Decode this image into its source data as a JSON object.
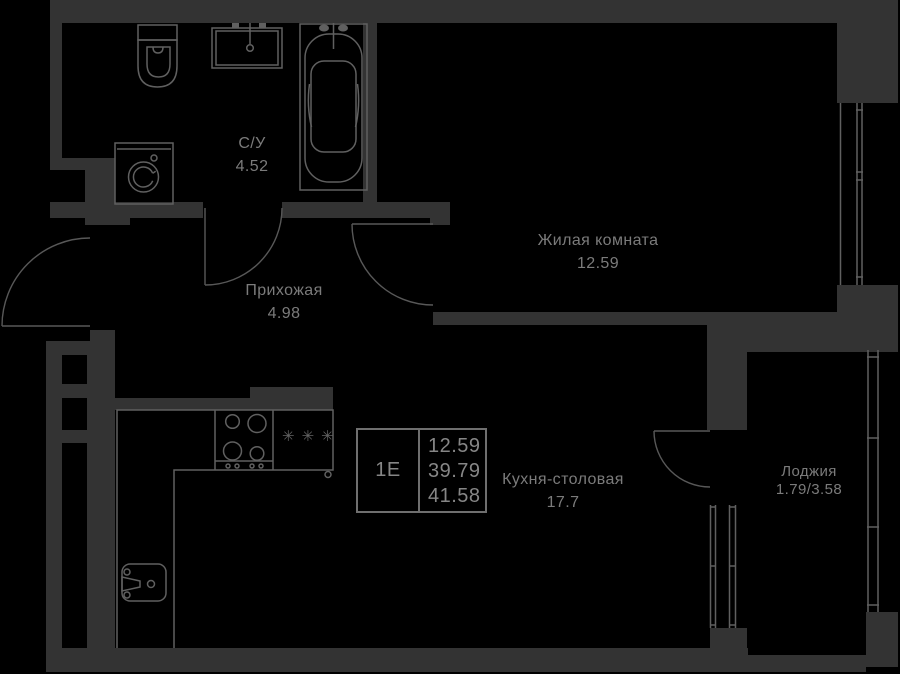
{
  "palette": {
    "background": "#000000",
    "wall": "#333333",
    "fixture_line": "#606060",
    "text": "#7b7b7b",
    "box_border": "#6f6f6f"
  },
  "unit_info_box": {
    "type": "1Е",
    "values": [
      "12.59",
      "39.79",
      "41.58"
    ]
  },
  "rooms": [
    {
      "name": "С/У",
      "area": "4.52"
    },
    {
      "name": "Жилая комната",
      "area": "12.59"
    },
    {
      "name": "Прихожая",
      "area": "4.98"
    },
    {
      "name": "Кухня-столовая",
      "area": "17.7"
    },
    {
      "name": "Лоджия",
      "area": "1.79/3.58"
    }
  ],
  "icons": {
    "fridge_symbol": "✳✳✳"
  }
}
